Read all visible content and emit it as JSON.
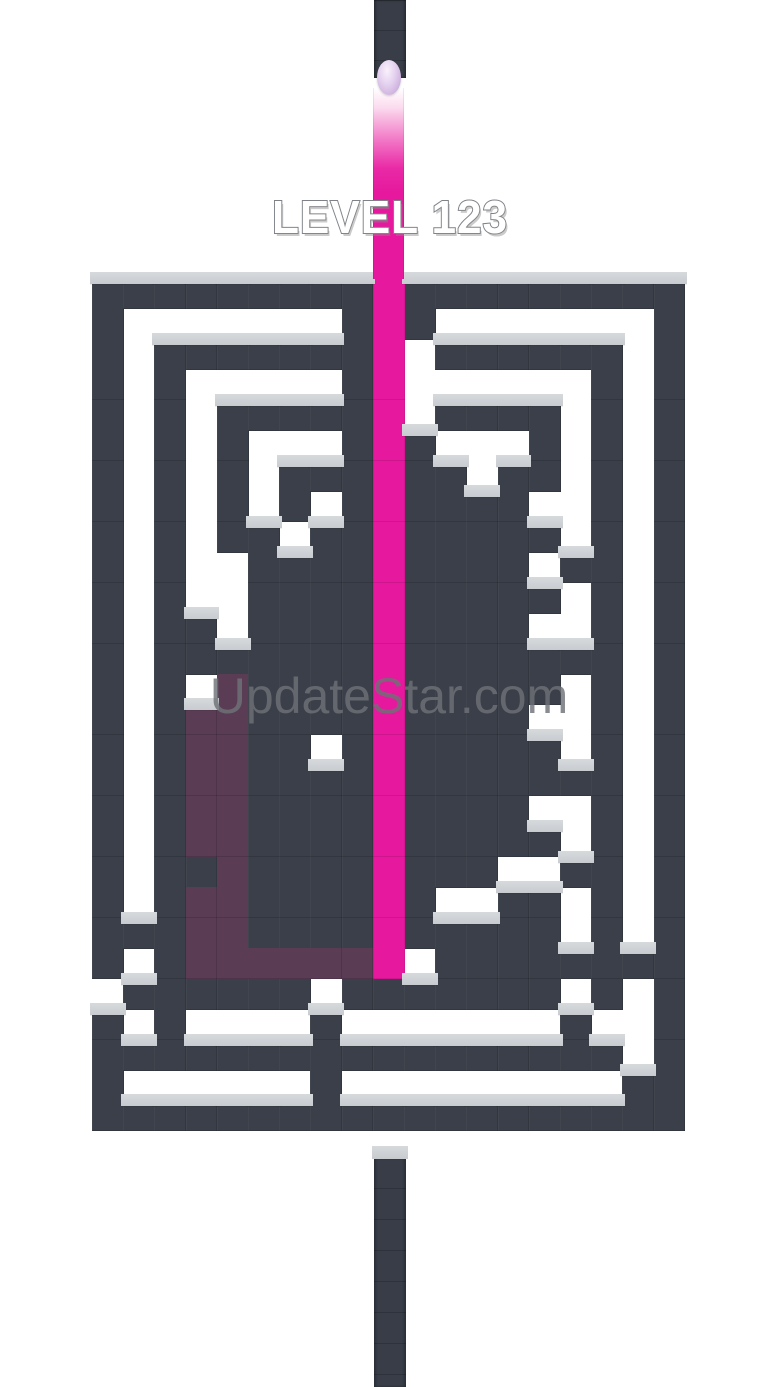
{
  "game": {
    "level_label": "LEVEL 123",
    "watermark_text": "UpdateStar.com"
  },
  "colors": {
    "background": "#ffffff",
    "wall": "#3a3f49",
    "wall_cap": "#ccd0d4",
    "paint_pink": "#e6189d",
    "painted_purple": "#5a3c55",
    "ball": "#d9c3e6",
    "level_text_fill": "#ffffff",
    "level_text_outline": "#7e8288",
    "watermark_gray": "#6e7277"
  },
  "icons": {
    "ball": "paint-ball",
    "top_channel": "ball-drop-channel",
    "bottom_channel": "maze-exit-channel"
  },
  "maze": {
    "rows": 28,
    "cols": 19,
    "legend": {
      "W": "wall-block",
      "U": "painted-purple-block",
      "P": "pink-paint-column",
      ".": "empty"
    },
    "grid": [
      "WWWWWWWWWPWWWWWWWWW",
      "W.......WPW.......W",
      "W.WWWWWWWP.WWWWWW.W",
      "W.W.....WP......W.W",
      "W.W.WWWWWP.WWWW.W.W",
      "W.W.W...WPW...W.W.W",
      "W.W.W.WWWPWW.WW.W.W",
      "W.W.W.W.WPWWWW..W.W",
      "W.W.WW.WWPWWWWW.W.W",
      "W.W..WWWWPWWWW.WW.W",
      "W.W..WWWWPWWWWW.W.W",
      "W.WW.WWWWPWWWW..W.W",
      "W.WWWWWWWPWWWWWWW.W",
      "W.W.UWWWWPWWWWW.W.W",
      "W.WUUWWWWPWWWW..W.W",
      "W.WUUWW.WPWWWWW.W.W",
      "W.WUUWWWWPWWWWWWW.W",
      "W.WUUWWWWPWWWW..W.W",
      "W.WUUWWWWPWWWWW.W.W",
      "W.WWUWWWWPWWW..WW.W",
      "W.WUUWWWWPW..WW.W.W",
      "WWWUUWWWWPWWWWW.W.W",
      "W.WUUUUUUP.WWWWWWWW",
      ".WWWWWW.WWWWWWW.W.W",
      "W.W....W.......W..W",
      "WWWWWWWWWWWWWWWWW.W",
      "W......W.........WW",
      "WWWWWWWWWWWWWWWWWWW"
    ]
  }
}
